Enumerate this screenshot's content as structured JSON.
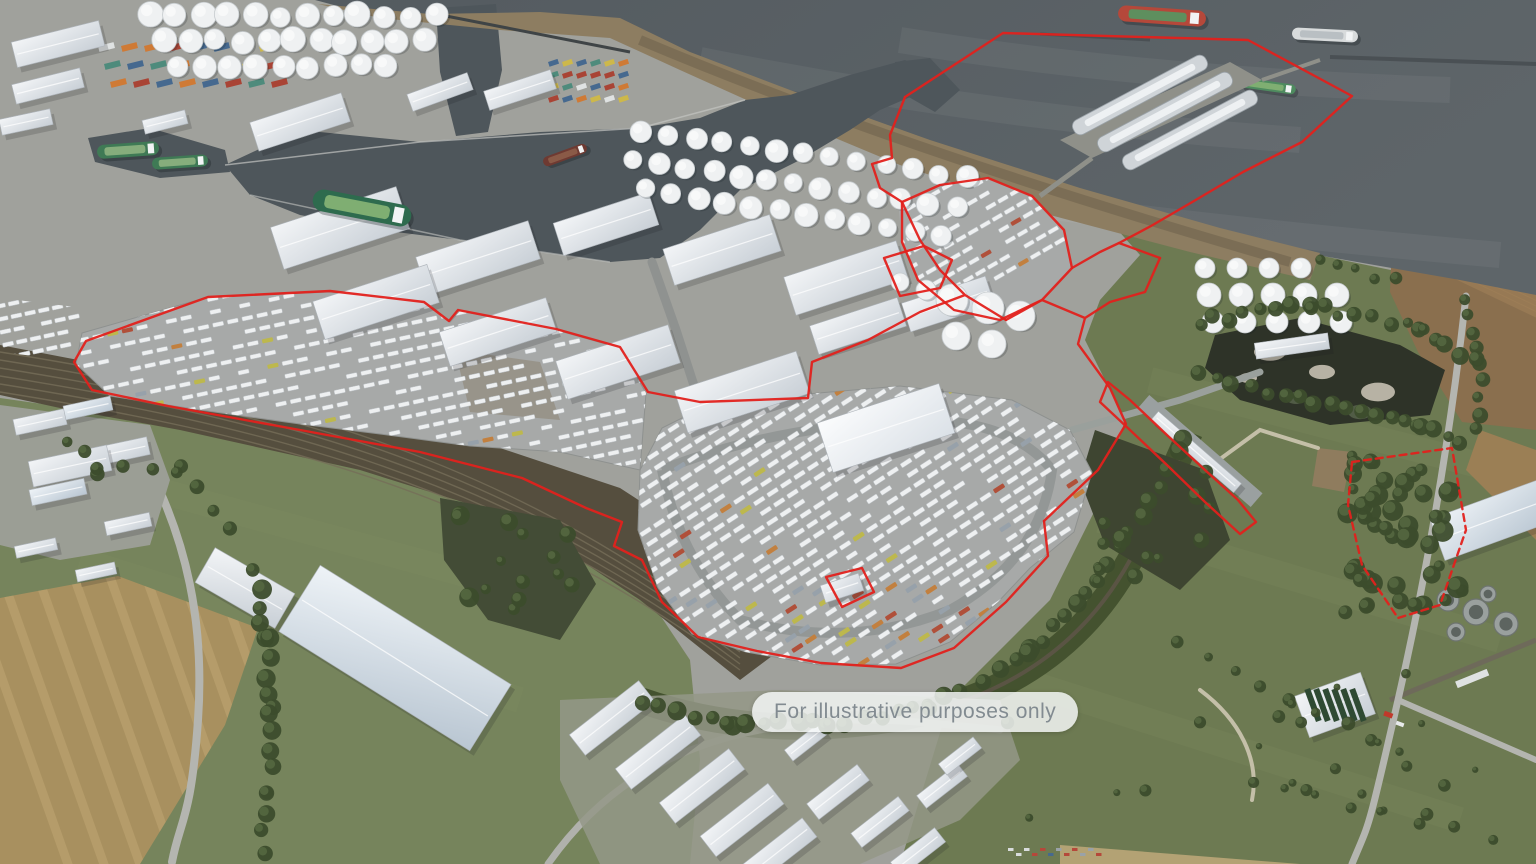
{
  "caption": {
    "text": "For illustrative purposes only"
  },
  "colors": {
    "boundary_red": "#e2211c",
    "estuary_water": "#596065",
    "dock_water": "#4e565b",
    "mudflat": "#8d7d61",
    "industrial_ground": "#a0a19c",
    "render_pavement": "#a7a9a8",
    "building_roof": "#eceef0",
    "grass": "#76845c",
    "scrub_green": "#6d7a52",
    "woodland": "#3c4c2c",
    "farmland": "#8a6f4e",
    "farmland_light": "#a8905f",
    "rail_corridor": "#554e3e",
    "lagoon": "#2e3328",
    "ship_hull_green": "#2e6b4e",
    "caption_text": "#828b91",
    "caption_background": "rgba(248,250,250,0.82)"
  },
  "scene": {
    "regions": [
      "estuary-water",
      "dock-basin",
      "jetty-terminal",
      "tank-farms",
      "warehouse-district",
      "left-trailer-yard",
      "central-development-pad",
      "rail-corridor",
      "woodland-and-fields",
      "industrial-estate-south",
      "site-boundary-overlay"
    ]
  }
}
